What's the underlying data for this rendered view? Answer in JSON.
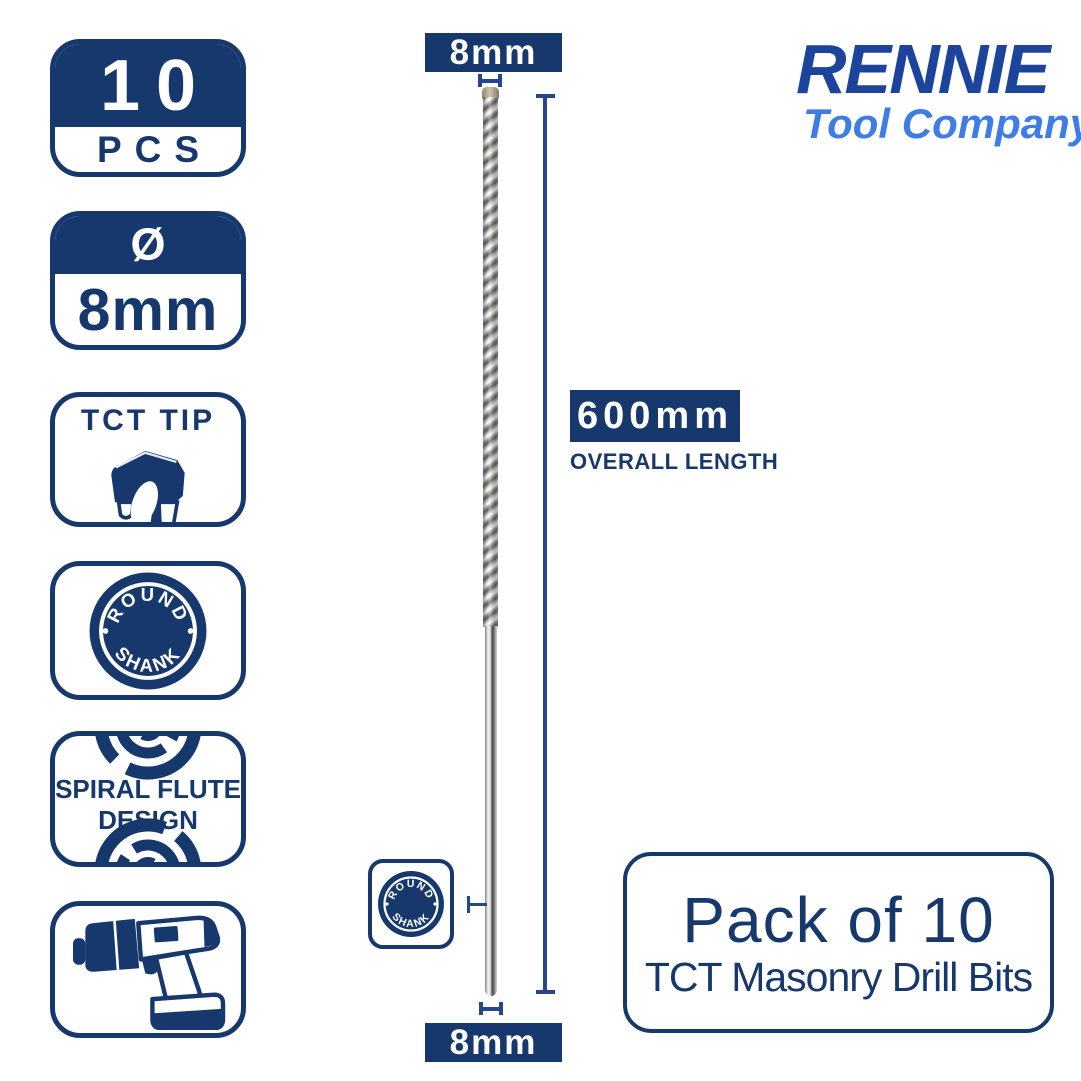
{
  "colors": {
    "navy": "#17386d",
    "line": "#24478e",
    "logo_dark": "#1d449c",
    "logo_light": "#3f7de6"
  },
  "badges": {
    "pcs": {
      "value": "10",
      "unit": "PCS"
    },
    "diameter": {
      "symbol": "Ø",
      "value": "8mm"
    },
    "tct_tip": {
      "label": "TCT TIP"
    },
    "round_shank": {
      "word_top": "ROUND",
      "word_bottom": "SHANK"
    },
    "spiral": {
      "line1": "SPIRAL FLUTE",
      "line2": "DESIGN"
    }
  },
  "drill_bit": {
    "tip_diameter_label": "8mm",
    "shank_diameter_label": "8mm",
    "overall_length_value": "600mm",
    "overall_length_caption": "OVERALL LENGTH"
  },
  "logo": {
    "brand": "RENNIE",
    "tagline": "Tool Company"
  },
  "product_box": {
    "title": "Pack of 10",
    "subtitle": "TCT Masonry Drill Bits"
  }
}
